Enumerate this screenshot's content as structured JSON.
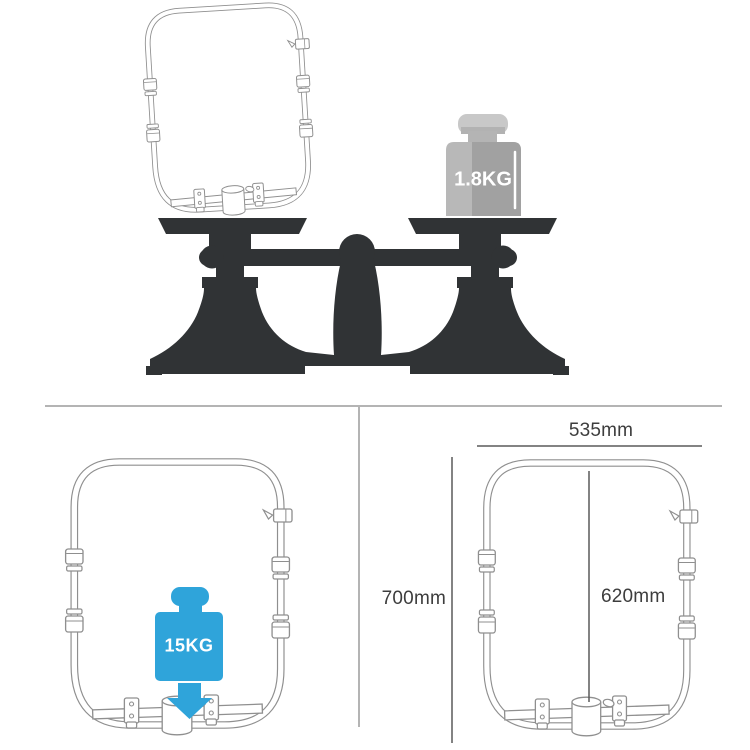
{
  "top_section": {
    "description_icons": [
      "balance-scale-silhouette",
      "rail-frame-on-scale",
      "weight-1point8kg-icon"
    ],
    "weight_label": "1.8KG"
  },
  "load_section": {
    "description_icons": [
      "rail-frame-load-test",
      "weight-15kg-icon",
      "down-arrow-icon"
    ],
    "weight_label": "15KG"
  },
  "dimension_section": {
    "description_icons": [
      "rail-frame-dimensions"
    ],
    "width_label": "535mm",
    "height_label": "700mm",
    "inner_height_label": "620mm"
  },
  "colors": {
    "background": "#ffffff",
    "scale_silhouette": "#303335",
    "weight_blue": "#2fa4da",
    "tube_gray": "#8f8f8f",
    "divider_gray": "#b4b4b4",
    "dimension_line": "#5a5a5a",
    "weight_gray_light": "#b5b5b5",
    "weight_gray_dark": "#9d9d9d",
    "weight_knob_gray": "#c6c6c6",
    "label_text": "#3d3d3d",
    "weight_label_text": "#ffffff"
  }
}
